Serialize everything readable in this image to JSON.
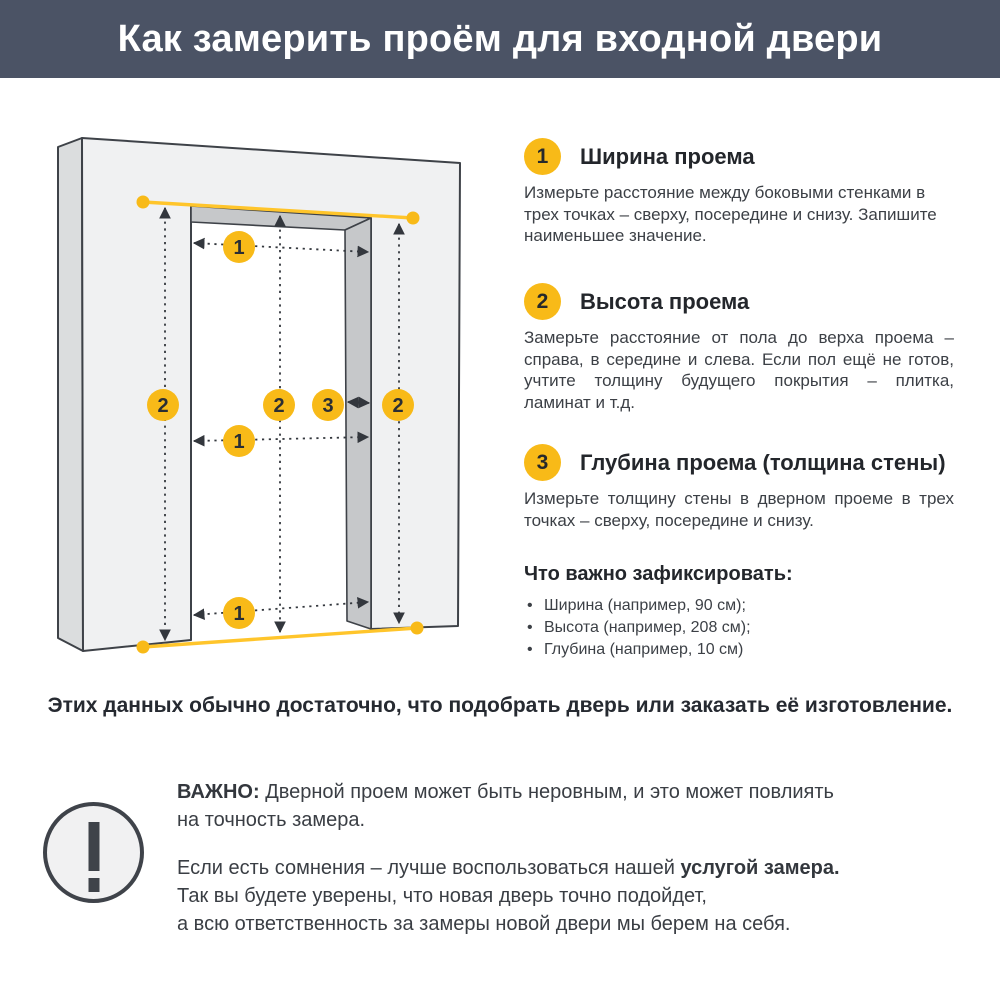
{
  "header": {
    "title": "Как замерить проём для входной двери"
  },
  "diagram": {
    "markers": [
      {
        "meaning": "width-top",
        "label": "1"
      },
      {
        "meaning": "width-middle",
        "label": "1"
      },
      {
        "meaning": "width-bottom",
        "label": "1"
      },
      {
        "meaning": "height-left",
        "label": "2"
      },
      {
        "meaning": "height-middle",
        "label": "2"
      },
      {
        "meaning": "height-right",
        "label": "2"
      },
      {
        "meaning": "depth",
        "label": "3"
      }
    ]
  },
  "sections": [
    {
      "number": "1",
      "title": "Ширина проема",
      "text": "Измерьте расстояние между боковыми стенками в трех точках – сверху, посередине и снизу. Запишите наименьшее значение."
    },
    {
      "number": "2",
      "title": "Высота проема",
      "text": "Замерьте расстояние от пола до верха проема – справа, в середине и слева. Если пол ещё не готов, учтите толщину будущего покрытия – плитка, ламинат и т.д."
    },
    {
      "number": "3",
      "title": "Глубина проема (толщина стены)",
      "text": "Измерьте толщину стены в дверном проеме в трех точках – сверху, посередине и снизу."
    }
  ],
  "checklist": {
    "title": "Что важно зафиксировать:",
    "bullet": "•",
    "items": [
      "Ширина (например, 90 см);",
      "Высота (например, 208 см);",
      "Глубина (например, 10 см)"
    ]
  },
  "summary": "Этих данных обычно достаточно, что подобрать дверь или заказать её изготовление.",
  "important": {
    "icon": "exclamation-icon",
    "p1_bold": "ВАЖНО:",
    "p1_rest": " Дверной проем может быть неровным, и это может повлиять\nна точность замера.",
    "p2_start": "Если есть сомнения – лучше воспользоваться нашей ",
    "p2_bold": "услугой замера.",
    "p2_rest": "\nТак вы будете уверены, что новая дверь точно подойдет,\nа всю ответственность за замеры новой двери мы берем на себя."
  },
  "colors": {
    "header_bg": "#4B5365",
    "accent_yellow": "#F8BA18",
    "measure_line_yellow": "#FFC52B",
    "wall_front": "#F0F1F2",
    "wall_side": "#DBDDDE",
    "wall_inner": "#C6C8CA",
    "outline_dark": "#3E4248",
    "text_dark": "#23262B",
    "text_body": "#3C4046"
  }
}
